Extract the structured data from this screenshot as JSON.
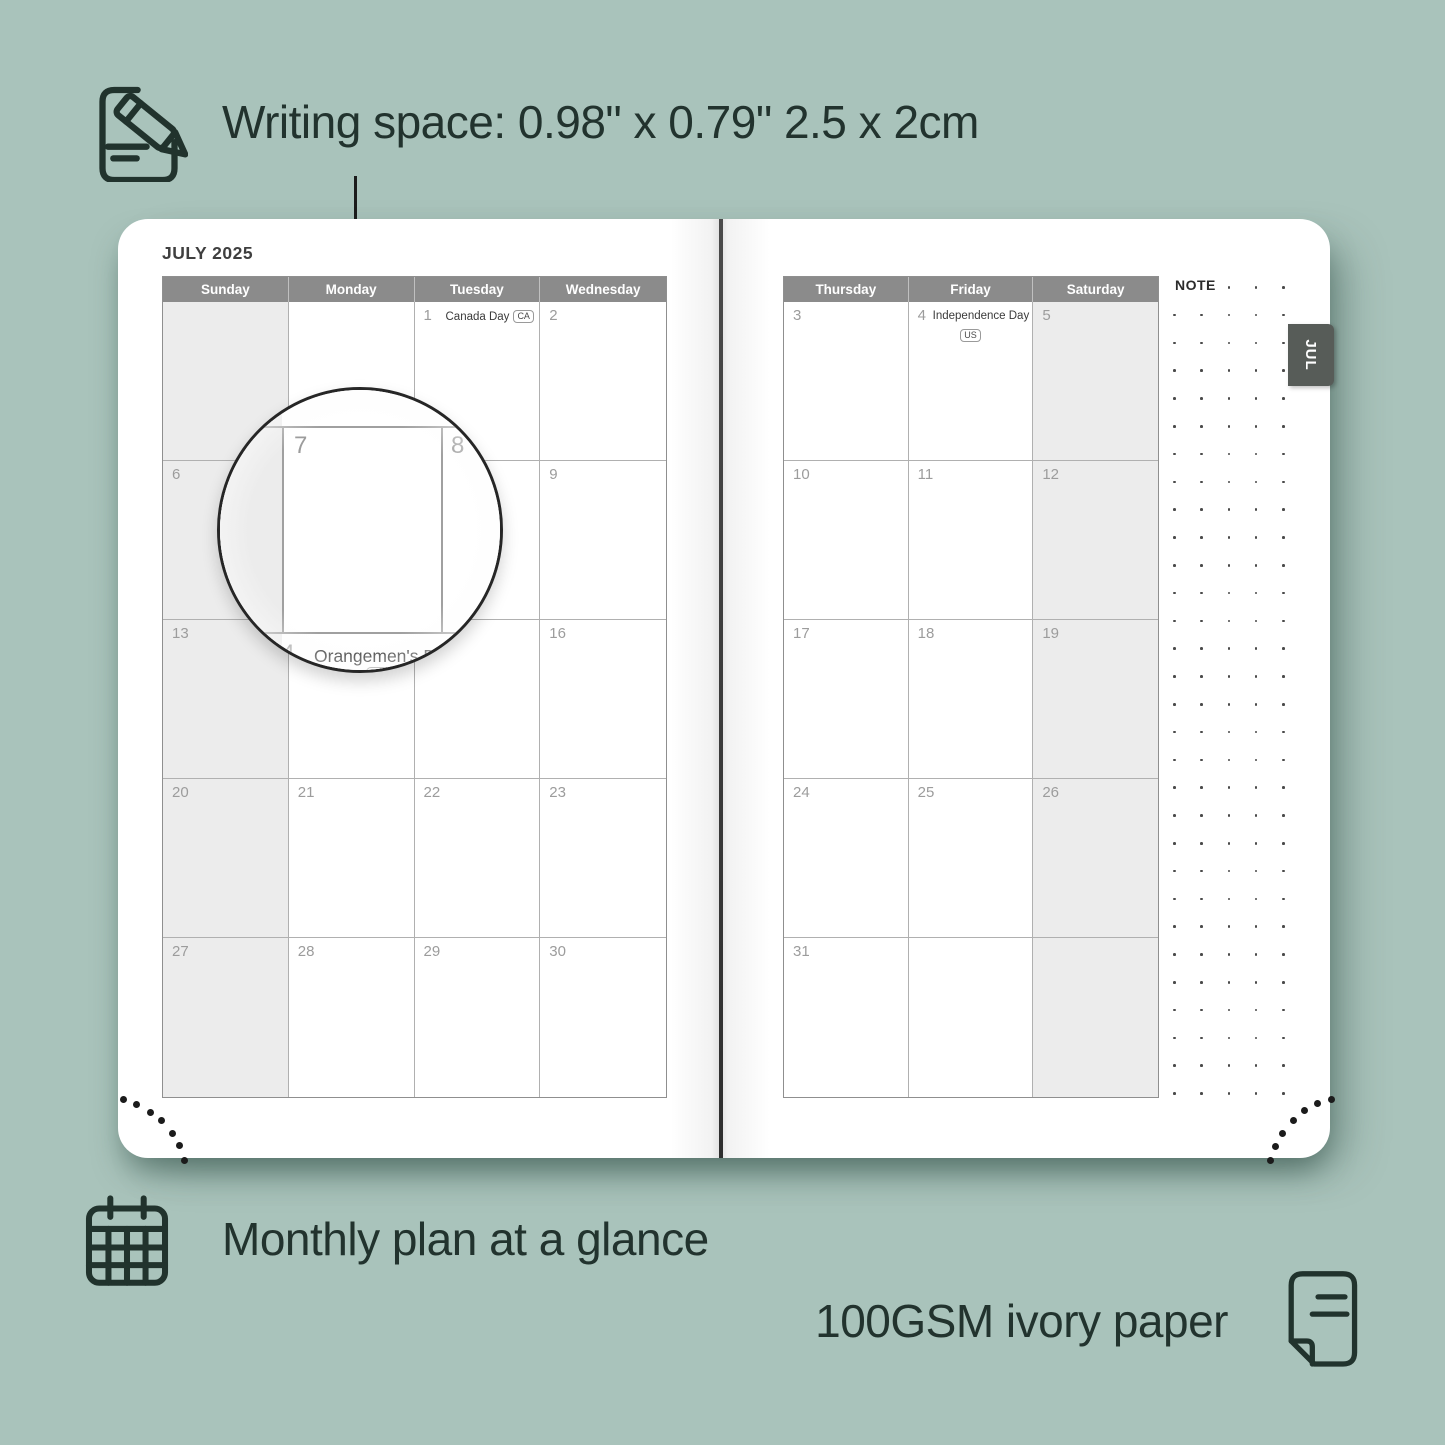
{
  "header": {
    "writing_space_label": "Writing space: 0.98\" x 0.79\" 2.5 x 2cm"
  },
  "footer": {
    "monthly_label": "Monthly plan at a glance",
    "paper_label": "100GSM ivory paper"
  },
  "planner": {
    "month_title": "JULY 2025",
    "tab_label": "JUL",
    "note_label": "NOTE",
    "left_headers": [
      "Sunday",
      "Monday",
      "Tuesday",
      "Wednesday"
    ],
    "right_headers": [
      "Thursday",
      "Friday",
      "Saturday"
    ],
    "left_rows": [
      [
        {
          "day": ""
        },
        {
          "day": ""
        },
        {
          "day": "1",
          "holiday": "Canada Day",
          "badge": "CA",
          "badge_pos": "inline"
        },
        {
          "day": "2"
        }
      ],
      [
        {
          "day": "6"
        },
        {
          "day": "7"
        },
        {
          "day": "8"
        },
        {
          "day": "9"
        }
      ],
      [
        {
          "day": "13"
        },
        {
          "day": "14",
          "holiday": "Orangemen's Day",
          "badge": "NL",
          "badge_pos": "below"
        },
        {
          "day": "15"
        },
        {
          "day": "16"
        }
      ],
      [
        {
          "day": "20"
        },
        {
          "day": "21"
        },
        {
          "day": "22"
        },
        {
          "day": "23"
        }
      ],
      [
        {
          "day": "27"
        },
        {
          "day": "28"
        },
        {
          "day": "29"
        },
        {
          "day": "30"
        }
      ]
    ],
    "right_rows": [
      [
        {
          "day": "3"
        },
        {
          "day": "4",
          "holiday": "Independence Day",
          "badge": "US",
          "badge_pos": "below"
        },
        {
          "day": "5"
        }
      ],
      [
        {
          "day": "10"
        },
        {
          "day": "11"
        },
        {
          "day": "12"
        }
      ],
      [
        {
          "day": "17"
        },
        {
          "day": "18"
        },
        {
          "day": "19"
        }
      ],
      [
        {
          "day": "24"
        },
        {
          "day": "25"
        },
        {
          "day": "26"
        }
      ],
      [
        {
          "day": "31"
        },
        {
          "day": ""
        },
        {
          "day": ""
        }
      ]
    ],
    "magnifier": {
      "day": "7",
      "right_day": "8",
      "below_day": "14",
      "below_holiday": "Orangemen's Day",
      "below_badge": "NL"
    }
  },
  "icons": {
    "top_left": "pencil-note-icon",
    "bottom_left": "calendar-grid-icon",
    "bottom_right": "paper-sheet-icon"
  },
  "colors": {
    "bg": "#a9c3bb",
    "ink": "#22332e",
    "page": "#ffffff",
    "header_bg": "#8b8b8b",
    "header_text": "#ffffff",
    "weekend": "#ececec",
    "grid_line": "#b0b0b0",
    "outer_line": "#8f8f8f",
    "day_num": "#9c9c9c",
    "holiday": "#3a3a3a",
    "badge_line": "#9a9a9a",
    "tab_bg": "#575c58",
    "tab_text": "#ffffff",
    "note_dot": "#4a4a4a",
    "corner_dot": "#1b1b1b",
    "spine": "#3c3c3c"
  }
}
